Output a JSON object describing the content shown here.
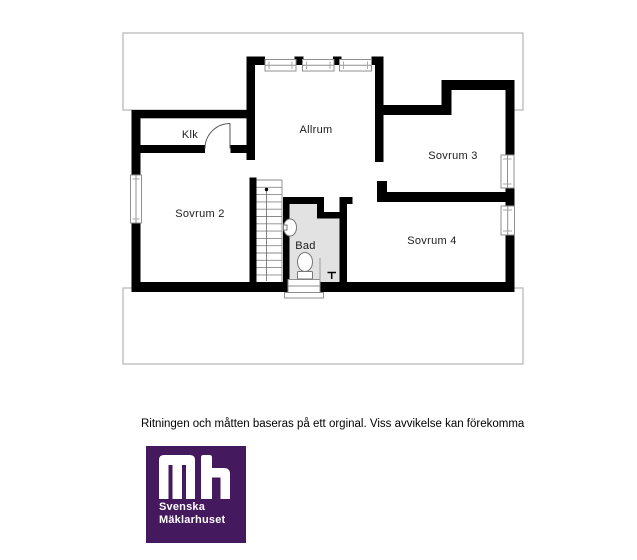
{
  "floorplan": {
    "rooms": [
      {
        "id": "klk",
        "label": "Klk"
      },
      {
        "id": "allrum",
        "label": "Allrum"
      },
      {
        "id": "sovrum3",
        "label": "Sovrum 3"
      },
      {
        "id": "sovrum2",
        "label": "Sovrum 2"
      },
      {
        "id": "bad",
        "label": "Bad"
      },
      {
        "id": "sovrum4",
        "label": "Sovrum 4"
      }
    ]
  },
  "disclaimer": "Ritningen och måtten baseras på ett orginal. Viss avvikelse kan förekomma",
  "logo": {
    "monogram": "mh",
    "line1": "Svenska",
    "line2": "Mäklarhuset"
  },
  "colors": {
    "brand_purple": "#45195e",
    "wall_black": "#000000",
    "bath_floor_gray": "#e2e2e2",
    "outline_gray": "#b5b5b5"
  }
}
